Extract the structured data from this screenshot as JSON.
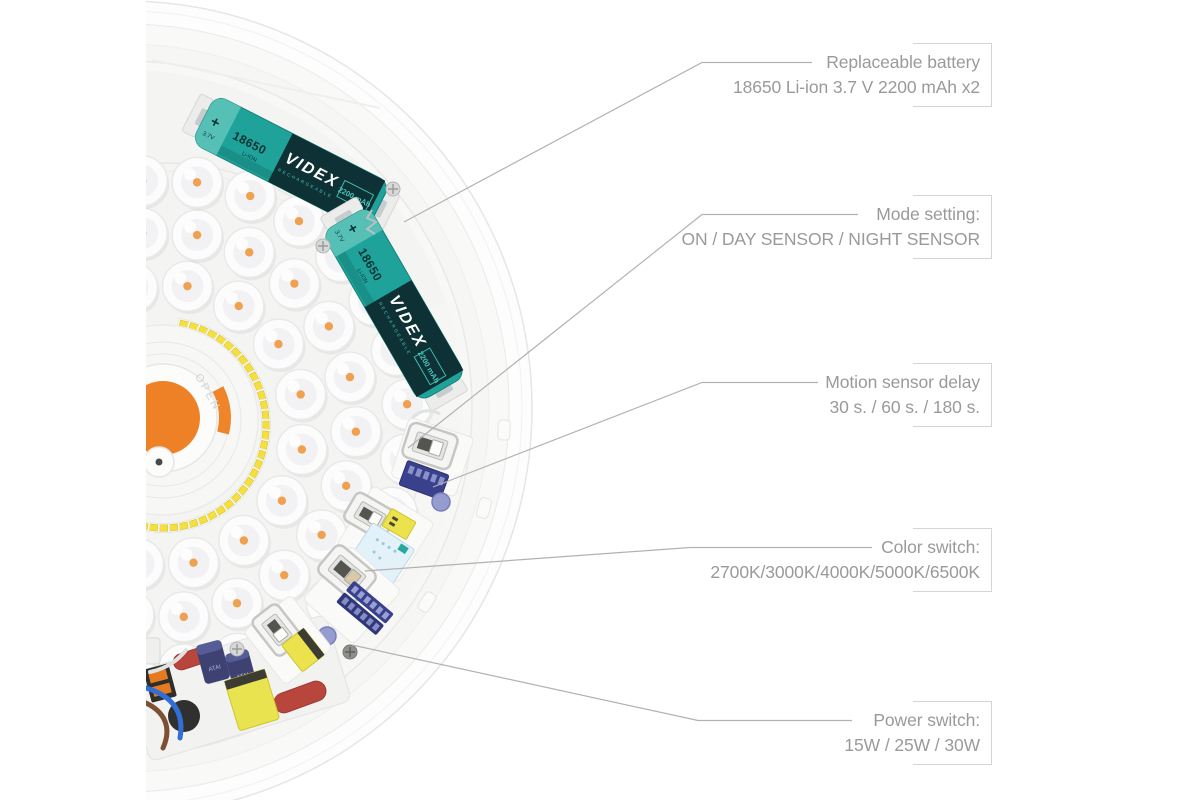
{
  "page": {
    "background": "#ffffff"
  },
  "lamp": {
    "open_label": "OPEN",
    "battery_label": {
      "polarity": "+",
      "voltage": "3.7V",
      "size": "18650",
      "chemistry": "Li-ION",
      "brand": "VIDEX",
      "brand_sub": "RECHARGEABLE",
      "capacity": "2200 mAh"
    },
    "capacitor_marking": "ATAI"
  },
  "annotations": [
    {
      "title": "Replaceable battery",
      "detail": "18650 Li-ion 3.7 V 2200 mAh x2"
    },
    {
      "title": "Mode setting:",
      "detail": "ON / DAY SENSOR / NIGHT SENSOR"
    },
    {
      "title": "Motion sensor delay",
      "detail": "30 s. / 60 s. / 180 s."
    },
    {
      "title": "Color switch:",
      "detail": "2700K/3000K/4000K/5000K/6500K"
    },
    {
      "title": "Power switch:",
      "detail": "15W / 25W / 30W"
    }
  ],
  "colors": {
    "battery_teal": "#1fa29a",
    "battery_cap_teal": "#56c0b7",
    "battery_dark": "#0d3134",
    "battery_text_teal": "#4cc6bb",
    "accent_orange": "#ee8126",
    "led_dot_orange": "#f0a14f",
    "smd_yellow": "#f4df3f",
    "dip_navy": "#39418c",
    "pcb_blue": "#e3f1f9",
    "label_text": "#9a9a9a",
    "leader_line": "#b2b2b2",
    "bracket": "#d4d4d4"
  }
}
